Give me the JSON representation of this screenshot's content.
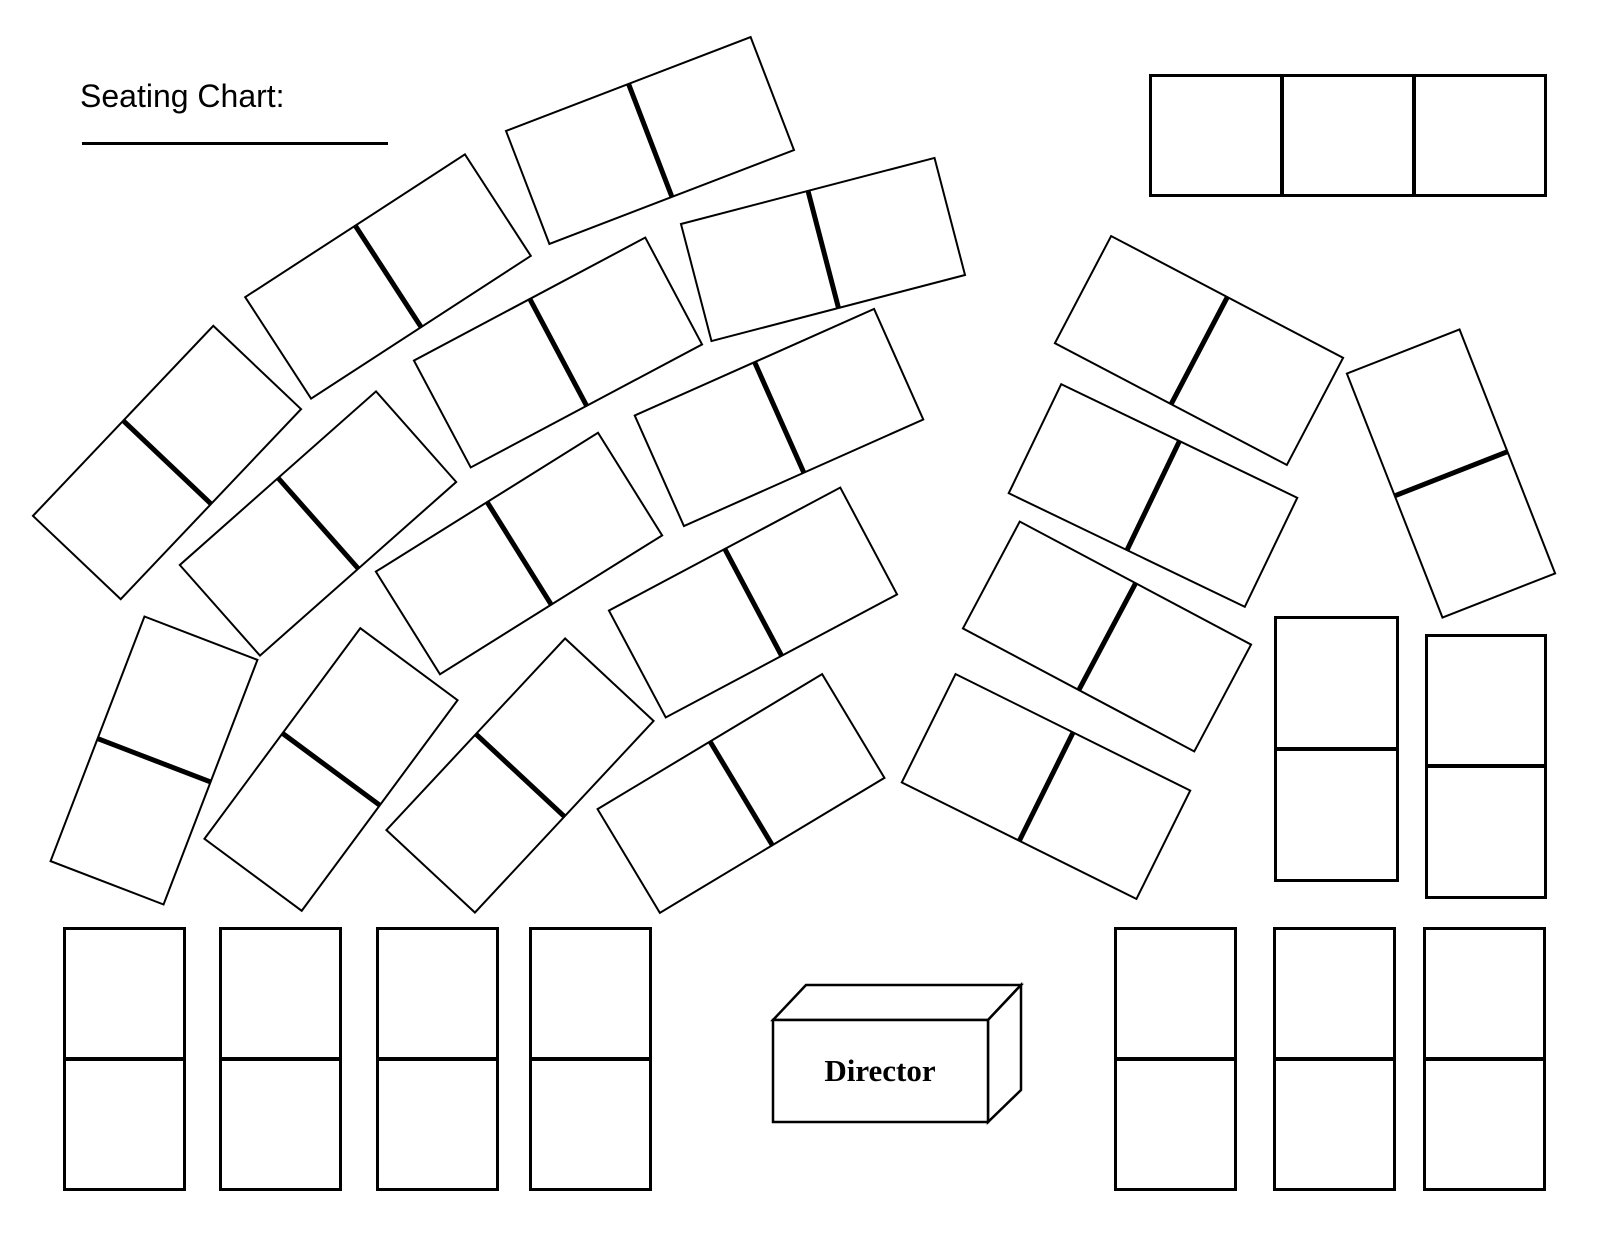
{
  "title": {
    "label": "Seating Chart:"
  },
  "director": {
    "label": "Director"
  },
  "colors": {
    "ink": "#000000",
    "paper": "#ffffff"
  },
  "canvas": {
    "width": 1600,
    "height": 1237
  },
  "back_table": {
    "x": 1149,
    "y": 74,
    "w": 398,
    "h": 123,
    "cells": 3
  },
  "seats": {
    "fan": {
      "size": {
        "w": 264,
        "h": 123
      },
      "items": [
        {
          "cx": 167,
          "cy": 462,
          "rot": -46.5
        },
        {
          "cx": 388,
          "cy": 276,
          "rot": -33
        },
        {
          "cx": 650,
          "cy": 140,
          "rot": -21
        },
        {
          "cx": 823,
          "cy": 249,
          "rot": -14.6
        },
        {
          "cx": 154,
          "cy": 760,
          "rot": -69
        },
        {
          "cx": 318,
          "cy": 523,
          "rot": -41.5
        },
        {
          "cx": 558,
          "cy": 352,
          "rot": -28
        },
        {
          "cx": 331,
          "cy": 769,
          "rot": -53.5
        },
        {
          "cx": 519,
          "cy": 553,
          "rot": -32
        },
        {
          "cx": 779,
          "cy": 417,
          "rot": -24
        },
        {
          "cx": 753,
          "cy": 602,
          "rot": -28
        },
        {
          "cx": 520,
          "cy": 775,
          "rot": -47
        },
        {
          "cx": 741,
          "cy": 793,
          "rot": -31
        },
        {
          "cx": 1046,
          "cy": 786,
          "rot": 26.4
        },
        {
          "cx": 1107,
          "cy": 636,
          "rot": 28
        },
        {
          "cx": 1153,
          "cy": 495,
          "rot": 25.7
        },
        {
          "cx": 1199,
          "cy": 350,
          "rot": 27.7
        },
        {
          "cx": 1451,
          "cy": 473,
          "rot": 68.6
        }
      ]
    },
    "bottom_left_row": {
      "size": {
        "w": 123,
        "h": 264
      },
      "cy": 1059,
      "cx_list": [
        124,
        280,
        437,
        590
      ]
    },
    "bottom_right_row": {
      "size": {
        "w": 123,
        "h": 264
      },
      "cy": 1059,
      "cx_list": [
        1175,
        1334,
        1484
      ]
    },
    "right_column": {
      "items": [
        {
          "cx": 1336,
          "cy": 749,
          "w": 125,
          "h": 266
        },
        {
          "cx": 1486,
          "cy": 766,
          "w": 122,
          "h": 265
        }
      ]
    }
  }
}
